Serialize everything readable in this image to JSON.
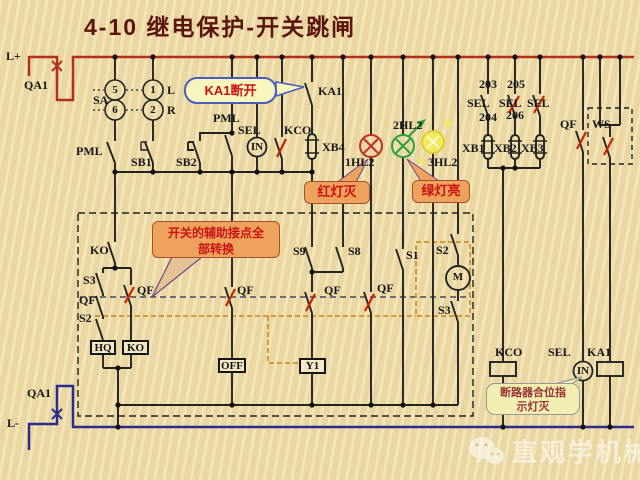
{
  "title": "4-10  继电保护-开关跳闸",
  "colors": {
    "bus_positive": "#b5301c",
    "bus_negative": "#2b2b8f",
    "wire": "#222222",
    "lamp_red": "#c23020",
    "lamp_green": "#2aa23a",
    "lamp_yellow": "#f4ea52",
    "operated_mark": "#cc2200",
    "mech_link_orange": "#c8851a",
    "mech_link_purple": "#4a4468"
  },
  "power": {
    "l_plus": "L+",
    "qa1_top": "QA1",
    "l_minus": "L-",
    "qa1_bottom": "QA1"
  },
  "labels": {
    "sa": "SA",
    "c5": "5",
    "c1": "1",
    "c6": "6",
    "c2": "2",
    "l": "L",
    "r": "R",
    "pml_left": "PML",
    "sb1": "SB1",
    "sb2": "SB2",
    "pml_mid": "PML",
    "sel_top": "SEL",
    "kco_top": "KCO",
    "ka1_top": "KA1",
    "in_top": "IN",
    "xb4": "XB4",
    "hl1": "1HL2",
    "hl2": "2HL2",
    "hl3": "3HL2",
    "n203": "203",
    "n205": "205",
    "n204": "204",
    "n206": "206",
    "sel_a": "SEL",
    "sel_b": "SEL",
    "sel_c": "SEL",
    "xb1": "XB1",
    "xb2": "XB2",
    "xb3": "XB3",
    "qf_top": "QF",
    "ws": "WS",
    "ko_contact": "KO",
    "s3_left": "S3",
    "qf_left": "QF",
    "s2_left": "S2",
    "qf_branch": "QF",
    "qf_off": "QF",
    "s9": "S9",
    "s8": "S8",
    "qf_y1": "QF",
    "qf_hl1": "QF",
    "s1": "S1",
    "s2_right": "S2",
    "m": "M",
    "s3_right": "S3",
    "hq": "HQ",
    "ko_box": "KO",
    "off": "OFF",
    "y1": "Y1",
    "kco_bot": "KCO",
    "sel_bot": "SEL",
    "ka1_bot": "KA1",
    "in_bot": "IN"
  },
  "callouts": {
    "ka1_open": "KA1断开",
    "red_off": "红灯灭",
    "green_on": "绿灯亮",
    "aux_line1": "开关的辅助接点全",
    "aux_line2": "部转换",
    "breaker_line1": "断路器合位指",
    "breaker_line2": "示灯灭"
  },
  "watermark": "直观学机械"
}
